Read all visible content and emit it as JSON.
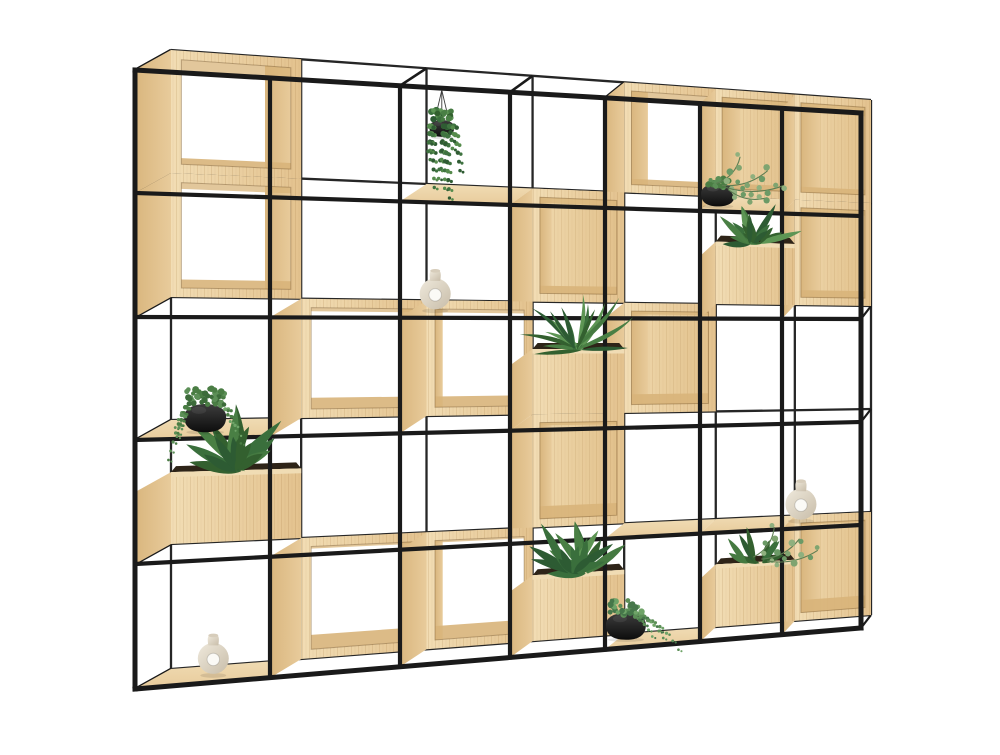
{
  "scene": {
    "subject": "modular-grid-shelving-with-plants",
    "background": "#ffffff"
  },
  "palette": {
    "frame_front": "#1a1a1a",
    "frame_back": "#262626",
    "wood_face_light": "#f2ddb4",
    "wood_face_dark": "#e3c28e",
    "wood_side_light": "#e8cb9b",
    "wood_side_dark": "#d9b67e",
    "wood_inner_light": "#efd8ac",
    "wood_inner_dark": "#e2c18c",
    "wood_top": "#f0dcb4",
    "wood_band": "#d8b47a",
    "soil": "#2e2418",
    "grain": "rgba(158,113,56,0.16)",
    "pot_black_hi": "#3d3d3d",
    "pot_black_lo": "#0d0d0d",
    "vase_light": "#efe9dc",
    "vase_dark": "#c8bda9",
    "greens": [
      "#2d5b33",
      "#3a6f3c",
      "#497f44",
      "#5d9554",
      "#33602f",
      "#457a41"
    ],
    "euc_greens": [
      "#7fa470",
      "#8fb07e",
      "#6b9a66"
    ]
  },
  "grid": {
    "x": [
      135,
      270,
      400,
      510,
      605,
      700,
      782,
      861
    ],
    "rowsLeft": [
      70,
      193,
      317,
      440,
      564,
      689
    ],
    "rowsRight": [
      113,
      216,
      319,
      422,
      525,
      628
    ],
    "depth": [
      [
        36,
        -20
      ],
      [
        10,
        -13
      ]
    ],
    "stroke_front": 4.2,
    "stroke_outer": 5,
    "stroke_back": 2.3
  },
  "cells": {
    "boxes": [
      {
        "col": 0,
        "row": 0,
        "interior": "open"
      },
      {
        "col": 4,
        "row": 0,
        "interior": "open"
      },
      {
        "col": 5,
        "row": 0,
        "interior": "wood"
      },
      {
        "col": 6,
        "row": 0,
        "interior": "wood"
      },
      {
        "col": 0,
        "row": 1,
        "interior": "open"
      },
      {
        "col": 3,
        "row": 1,
        "interior": "wood"
      },
      {
        "col": 6,
        "row": 1,
        "interior": "wood"
      },
      {
        "col": 1,
        "row": 2,
        "interior": "open"
      },
      {
        "col": 2,
        "row": 2,
        "interior": "open"
      },
      {
        "col": 4,
        "row": 2,
        "interior": "wood"
      },
      {
        "col": 3,
        "row": 3,
        "interior": "wood"
      },
      {
        "col": 1,
        "row": 4,
        "interior": "open"
      },
      {
        "col": 2,
        "row": 4,
        "interior": "open"
      },
      {
        "col": 6,
        "row": 4,
        "interior": "wood"
      }
    ],
    "planters": [
      {
        "col": 5,
        "row": 1,
        "plant": "leafy"
      },
      {
        "col": 3,
        "row": 2,
        "plant": "dracaena"
      },
      {
        "col": 0,
        "row": 3,
        "plant": "leafy"
      },
      {
        "col": 3,
        "row": 4,
        "plant": "lush"
      },
      {
        "col": 5,
        "row": 4,
        "plant": "mixed"
      }
    ],
    "shelves": [
      {
        "col": 2,
        "row": 0
      },
      {
        "col": 3,
        "row": 0
      },
      {
        "col": 5,
        "row": 0
      },
      {
        "col": 2,
        "row": 1
      },
      {
        "col": 0,
        "row": 2
      },
      {
        "col": 4,
        "row": 3
      },
      {
        "col": 5,
        "row": 3
      },
      {
        "col": 6,
        "row": 3
      },
      {
        "col": 0,
        "row": 4
      },
      {
        "col": 4,
        "row": 4
      }
    ]
  },
  "objects": [
    {
      "type": "hanging-plant",
      "col": 2,
      "row": 0,
      "fx": 0.38
    },
    {
      "type": "pot-eucalyptus",
      "col": 5,
      "row": 0,
      "fx": 0.22
    },
    {
      "type": "white-vase",
      "col": 2,
      "row": 1,
      "fx": 0.32
    },
    {
      "type": "pot-pearls",
      "col": 0,
      "row": 2,
      "fx": 0.52
    },
    {
      "type": "white-vase",
      "col": 6,
      "row": 3,
      "fx": 0.24
    },
    {
      "type": "pot-sedum",
      "col": 4,
      "row": 4,
      "fx": 0.22
    },
    {
      "type": "white-vase",
      "col": 0,
      "row": 4,
      "fx": 0.58
    }
  ]
}
